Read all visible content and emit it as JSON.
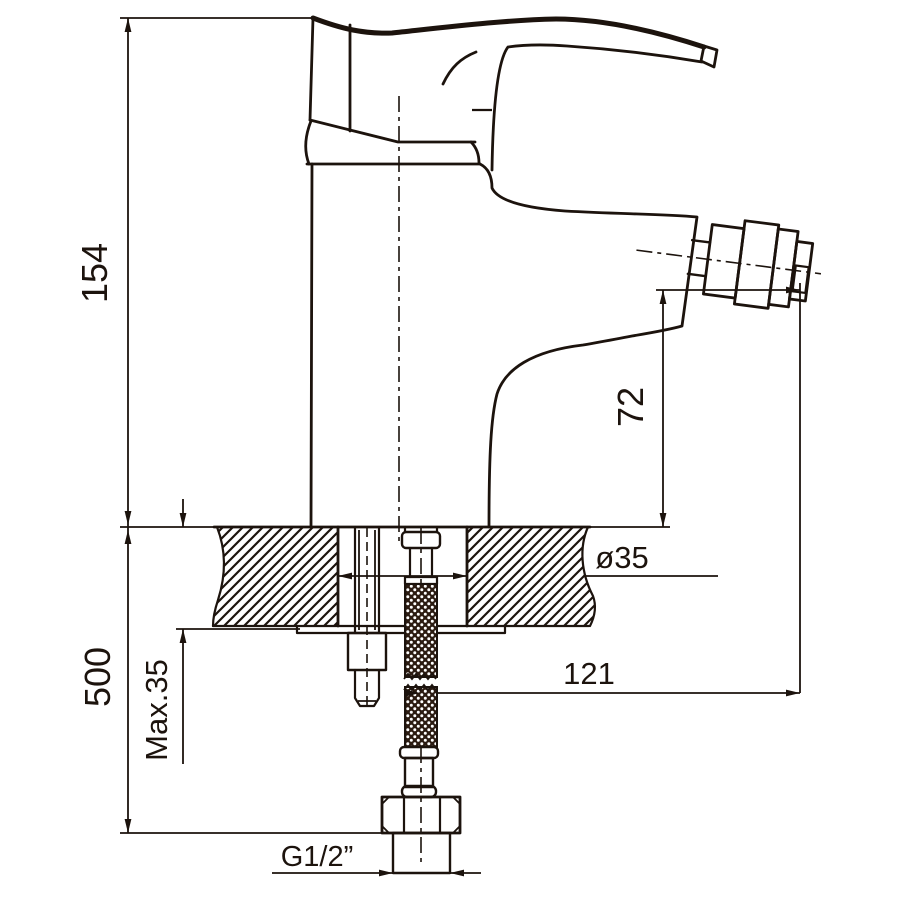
{
  "drawing": {
    "kind": "bidet-mixer-installation-dimension-drawing",
    "dimensions": {
      "overall_height": "154",
      "outlet_height": "72",
      "hose_length": "500",
      "max_mounting_thickness": "Max.35",
      "hole_diameter": "ø35",
      "outlet_reach": "121",
      "connection_thread": "G1/2”"
    },
    "colors": {
      "line": "#1c130d",
      "background": "#ffffff",
      "hose_braid": "#2b1b11"
    }
  }
}
